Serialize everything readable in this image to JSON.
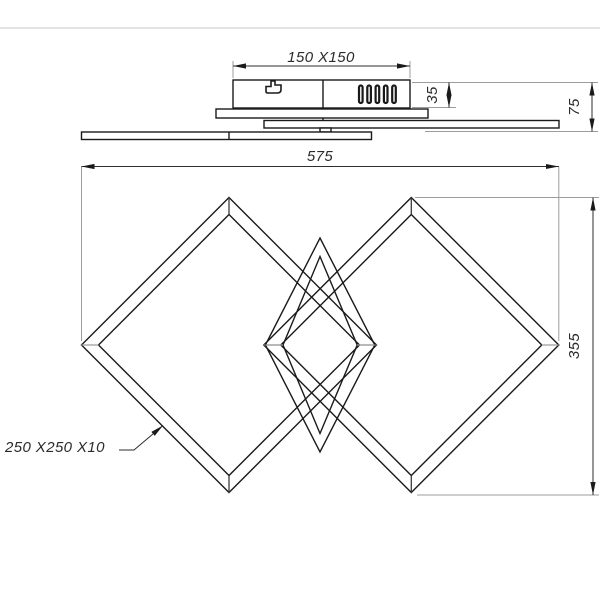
{
  "drawing": {
    "title": "ceiling-light dimension drawing",
    "divider_color": "#dcdcdc",
    "line_color": "#1a1a1a",
    "side_view": {
      "labels": {
        "canopy_size": "150 X150",
        "canopy_height": "35",
        "total_height": "75"
      },
      "icons": [
        "hook-icon",
        "vent-slots"
      ]
    },
    "front_view": {
      "labels": {
        "total_width": "575",
        "total_depth": "355",
        "frame_spec": "250 X250 X10"
      },
      "shapes": [
        "left-square-frame-rotated-45",
        "right-square-frame-rotated-45",
        "center-tilted-square-frame"
      ]
    }
  }
}
